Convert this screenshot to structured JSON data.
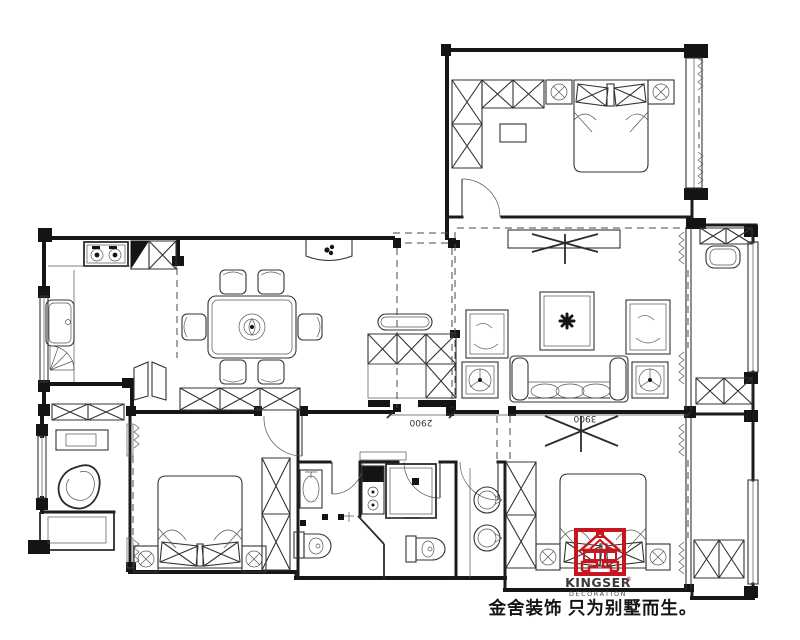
{
  "page": {
    "background": "#ffffff",
    "type": "architectural-floor-plan"
  },
  "plan": {
    "ink": "#2b2b2b",
    "wall_ink": "#161616",
    "accent_red": "#c8161e",
    "symbols": [
      "double-bed",
      "pillow",
      "wardrobe-xbox",
      "nightstand-lamp",
      "sofa",
      "armchair",
      "tv",
      "rug-medallion",
      "dining-table-six-chairs",
      "gas-stove",
      "kitchen-sink",
      "refrigerator",
      "toilet",
      "shower-cabin",
      "washbasin",
      "round-basin",
      "bean-chair",
      "desk",
      "plant",
      "curtain",
      "door-swing",
      "window",
      "column",
      "shoe-cabinet",
      "balcony-cabinet",
      "laundry-basin"
    ]
  },
  "dimensions": {
    "corridor": "2900",
    "master": "3900"
  },
  "logo": {
    "brand": "KINGSER",
    "registered": "®",
    "subtitle": "DECORATION",
    "tagline": "金舍装饰 只为别墅而生。",
    "brand_color": "#c8161e",
    "text_color": "#3a3a3a"
  }
}
